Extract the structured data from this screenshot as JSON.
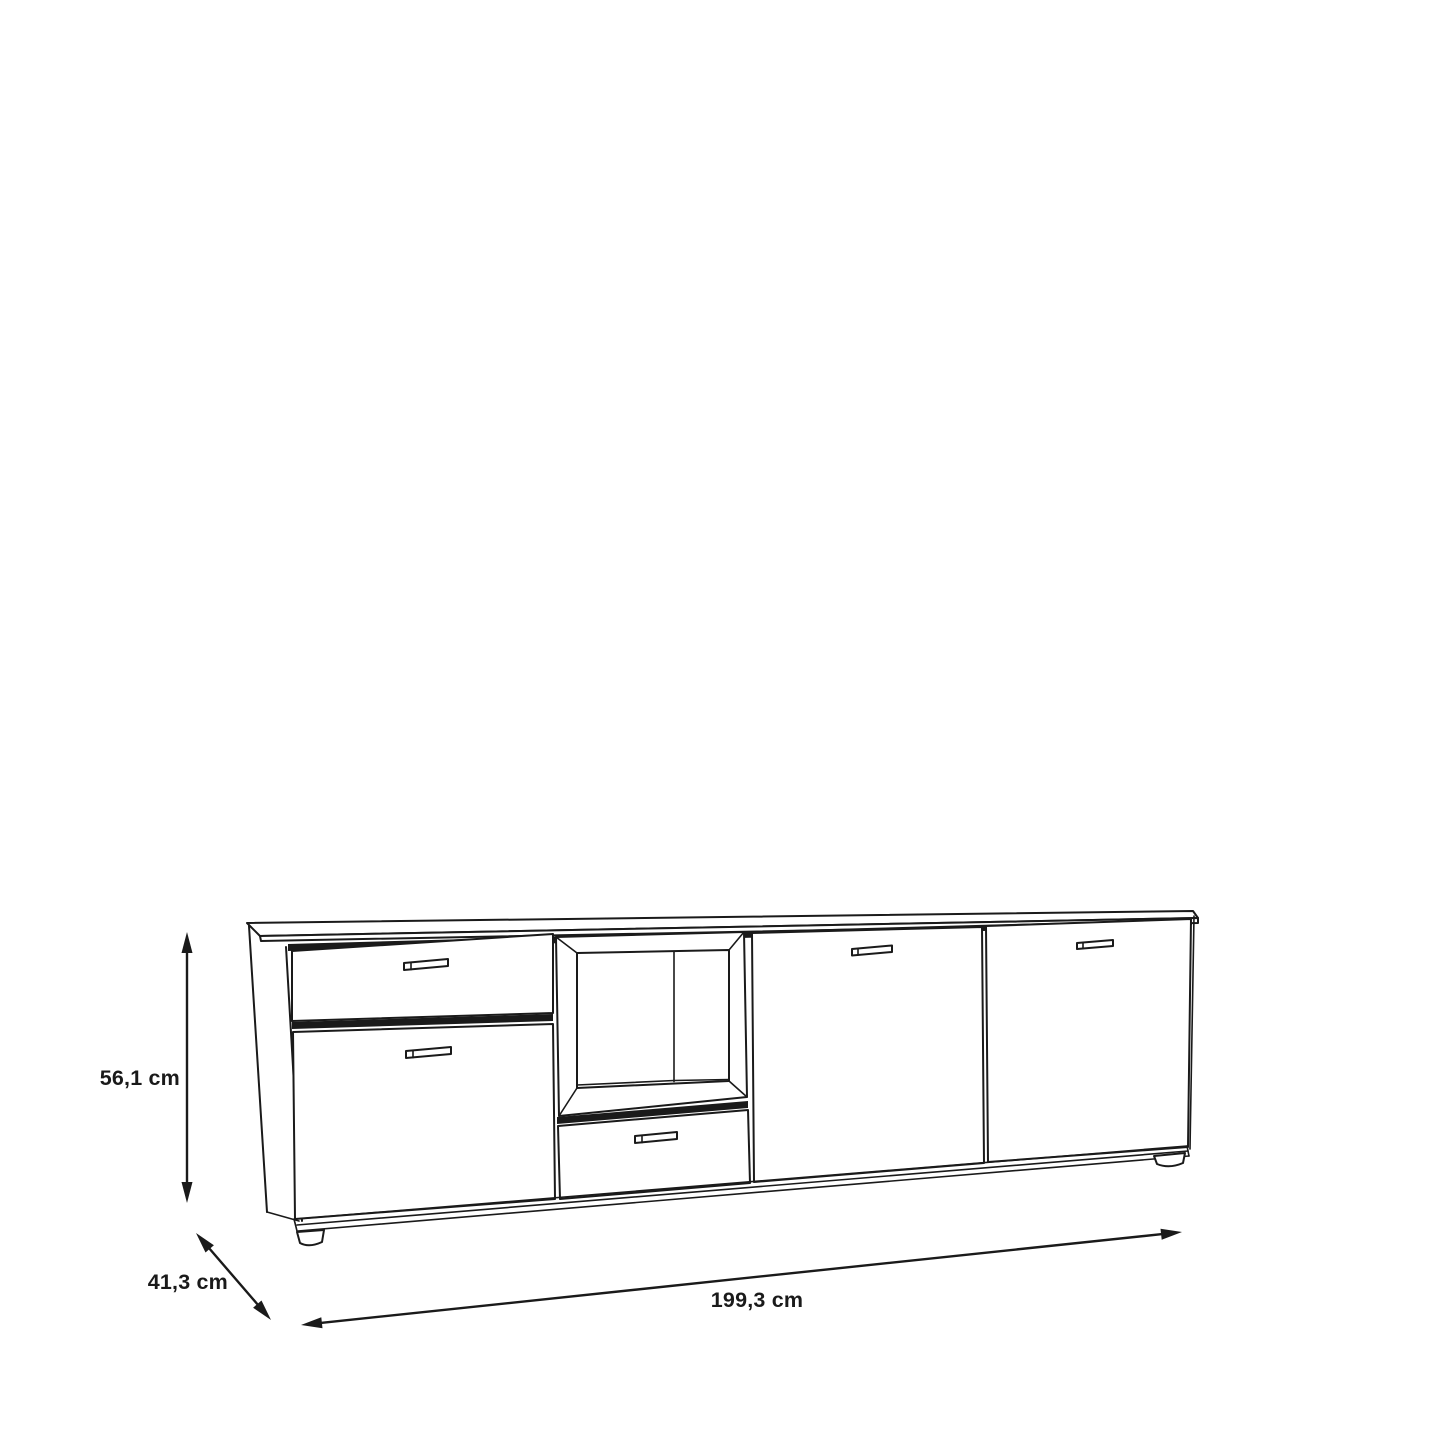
{
  "diagram": {
    "kind": "furniture-dimension-drawing",
    "object": "sideboard",
    "background_color": "#ffffff",
    "line_color": "#1a1a1a",
    "dimensions": {
      "height": {
        "label": "56,1 cm"
      },
      "depth": {
        "label": "41,3 cm"
      },
      "width": {
        "label": "199,3 cm"
      }
    },
    "features": {
      "sections": [
        {
          "name": "left",
          "parts": [
            "drawer",
            "door"
          ]
        },
        {
          "name": "center",
          "parts": [
            "open-niche",
            "drawer"
          ]
        },
        {
          "name": "center-right",
          "parts": [
            "door"
          ]
        },
        {
          "name": "right",
          "parts": [
            "door"
          ]
        }
      ],
      "handle_count": 5,
      "feet_count": 2
    }
  }
}
